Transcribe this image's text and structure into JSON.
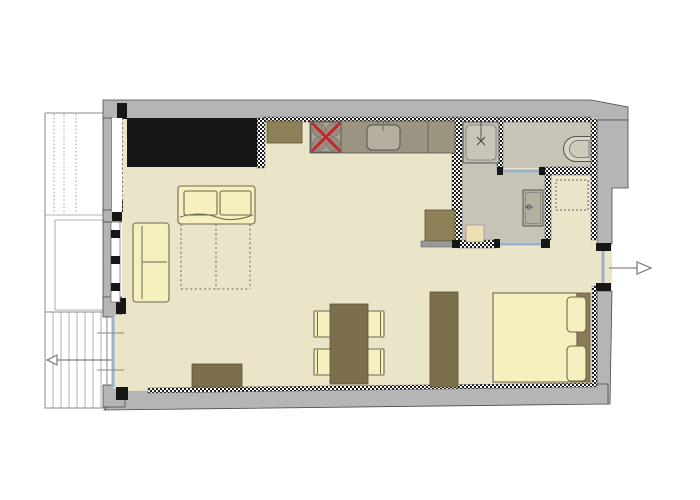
{
  "plan": {
    "type": "apartment-floor-plan",
    "rooms": [
      "living-dining-area",
      "kitchenette",
      "bathroom",
      "wc-room",
      "closet-niche",
      "sleeping-area",
      "entry-hall",
      "balcony",
      "staircase"
    ],
    "furniture": {
      "living": [
        "black-wardrobe",
        "sofa-bed-with-dashed-pullout",
        "two-seat-sofa",
        "dining-table",
        "dining-chairs-x4",
        "sideboard",
        "tall-cabinet"
      ],
      "kitchen": [
        "base-cabinet",
        "cooktop-with-red-cross",
        "counter-with-sink",
        "fridge-cabinet"
      ],
      "bathroom": [
        "shower",
        "washbasin-vanity",
        "laundry-box"
      ],
      "wc": [
        "toilet"
      ],
      "closet": [
        "dashed-wardrobe-footprint"
      ],
      "bedroom": [
        "double-bed",
        "headboard",
        "pillows-x2"
      ]
    },
    "symbols": {
      "entrance_arrow_direction": "right",
      "stairs_arrow_direction": "left",
      "stove_marker": "red-cross",
      "new_partition_walls": "checkered-hatch",
      "pullout_bed": "dashed-outline"
    }
  },
  "colors": {
    "background": "#ffffff",
    "wall": "#b5b5b5",
    "wall_outline": "#4a4a4a",
    "floor": "#eae4c9",
    "wet_floor": "#c7c4b7",
    "furniture_cream": "#f6efbe",
    "furniture_outline": "#6b6b4f",
    "wood_brown": "#7c6f4d",
    "wood_dark": "#5d5339",
    "olive_brown": "#8e8157",
    "headboard_brown": "#8a7a55",
    "counter_gray": "#9a9480",
    "counter_light": "#b5afa0",
    "black": "#161616",
    "stove_red": "#c1272d",
    "glazing_blue": "#9ab2c8",
    "line": "#555555"
  }
}
